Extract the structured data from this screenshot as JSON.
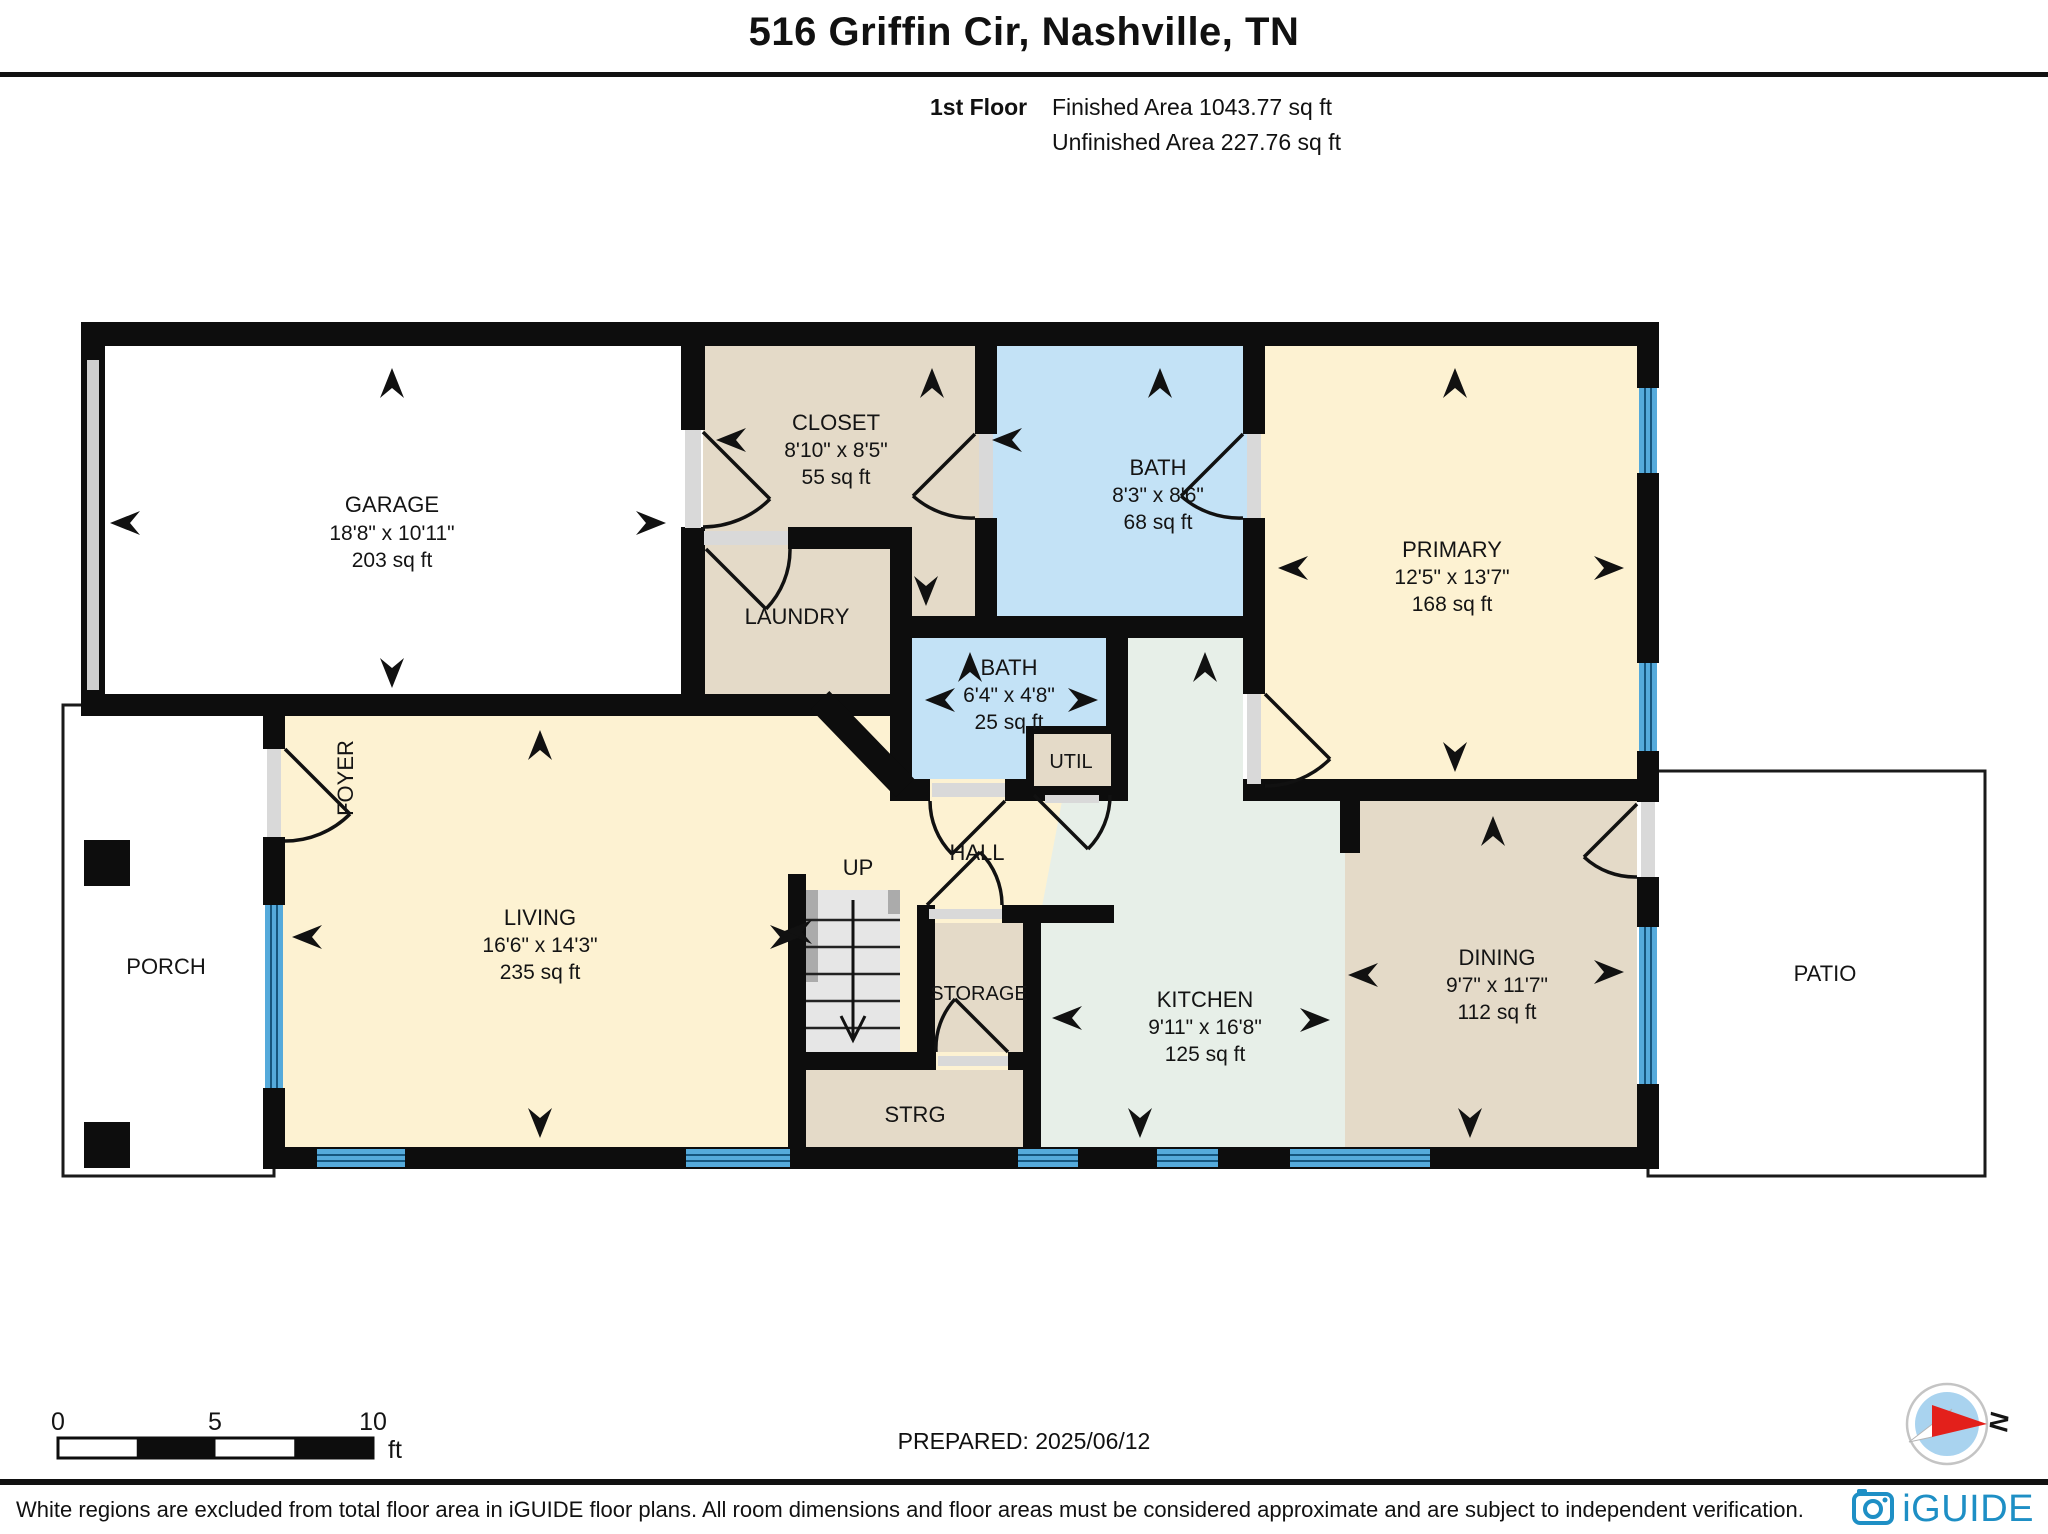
{
  "header": {
    "title": "516 Griffin Cir, Nashville, TN",
    "floor": "1st Floor",
    "finished": "Finished Area 1043.77 sq ft",
    "unfinished": "Unfinished Area 227.76 sq ft"
  },
  "rooms": {
    "garage": {
      "name": "GARAGE",
      "dims": "18'8\" x 10'11\"",
      "area": "203 sq ft"
    },
    "closet": {
      "name": "CLOSET",
      "dims": "8'10\" x 8'5\"",
      "area": "55 sq ft"
    },
    "bath_top": {
      "name": "BATH",
      "dims": "8'3\" x 8'6\"",
      "area": "68 sq ft"
    },
    "primary": {
      "name": "PRIMARY",
      "dims": "12'5\" x 13'7\"",
      "area": "168 sq ft"
    },
    "laundry": {
      "name": "LAUNDRY"
    },
    "bath_small": {
      "name": "BATH",
      "dims": "6'4\" x 4'8\"",
      "area": "25 sq ft"
    },
    "util": {
      "name": "UTIL"
    },
    "foyer": {
      "name": "FOYER"
    },
    "living": {
      "name": "LIVING",
      "dims": "16'6\" x 14'3\"",
      "area": "235 sq ft"
    },
    "up": {
      "name": "UP"
    },
    "hall": {
      "name": "HALL"
    },
    "storage": {
      "name": "STORAGE"
    },
    "strg": {
      "name": "STRG"
    },
    "kitchen": {
      "name": "KITCHEN",
      "dims": "9'11\" x 16'8\"",
      "area": "125 sq ft"
    },
    "dining": {
      "name": "DINING",
      "dims": "9'7\" x 11'7\"",
      "area": "112 sq ft"
    },
    "porch": {
      "name": "PORCH"
    },
    "patio": {
      "name": "PATIO"
    }
  },
  "scale_bar": {
    "t0": "0",
    "t5": "5",
    "t10": "10",
    "unit": "ft"
  },
  "prepared": "PREPARED: 2025/06/12",
  "compass": {
    "north": "N"
  },
  "footer": {
    "disclaimer": "White regions are excluded from total floor area in iGUIDE floor plans. All room dimensions and floor areas must be considered approximate and are subject to independent verification.",
    "brand": "iGUIDE"
  },
  "colors": {
    "cream": "#fdf2d2",
    "tan": "#e4dac8",
    "bath_blue": "#c3e2f6",
    "kitchen_green": "#e7efe8",
    "window_blue": "#55aadb",
    "wall": "#0d0d0d",
    "brand_blue": "#1e8fc5",
    "compass_red": "#e3201b"
  }
}
